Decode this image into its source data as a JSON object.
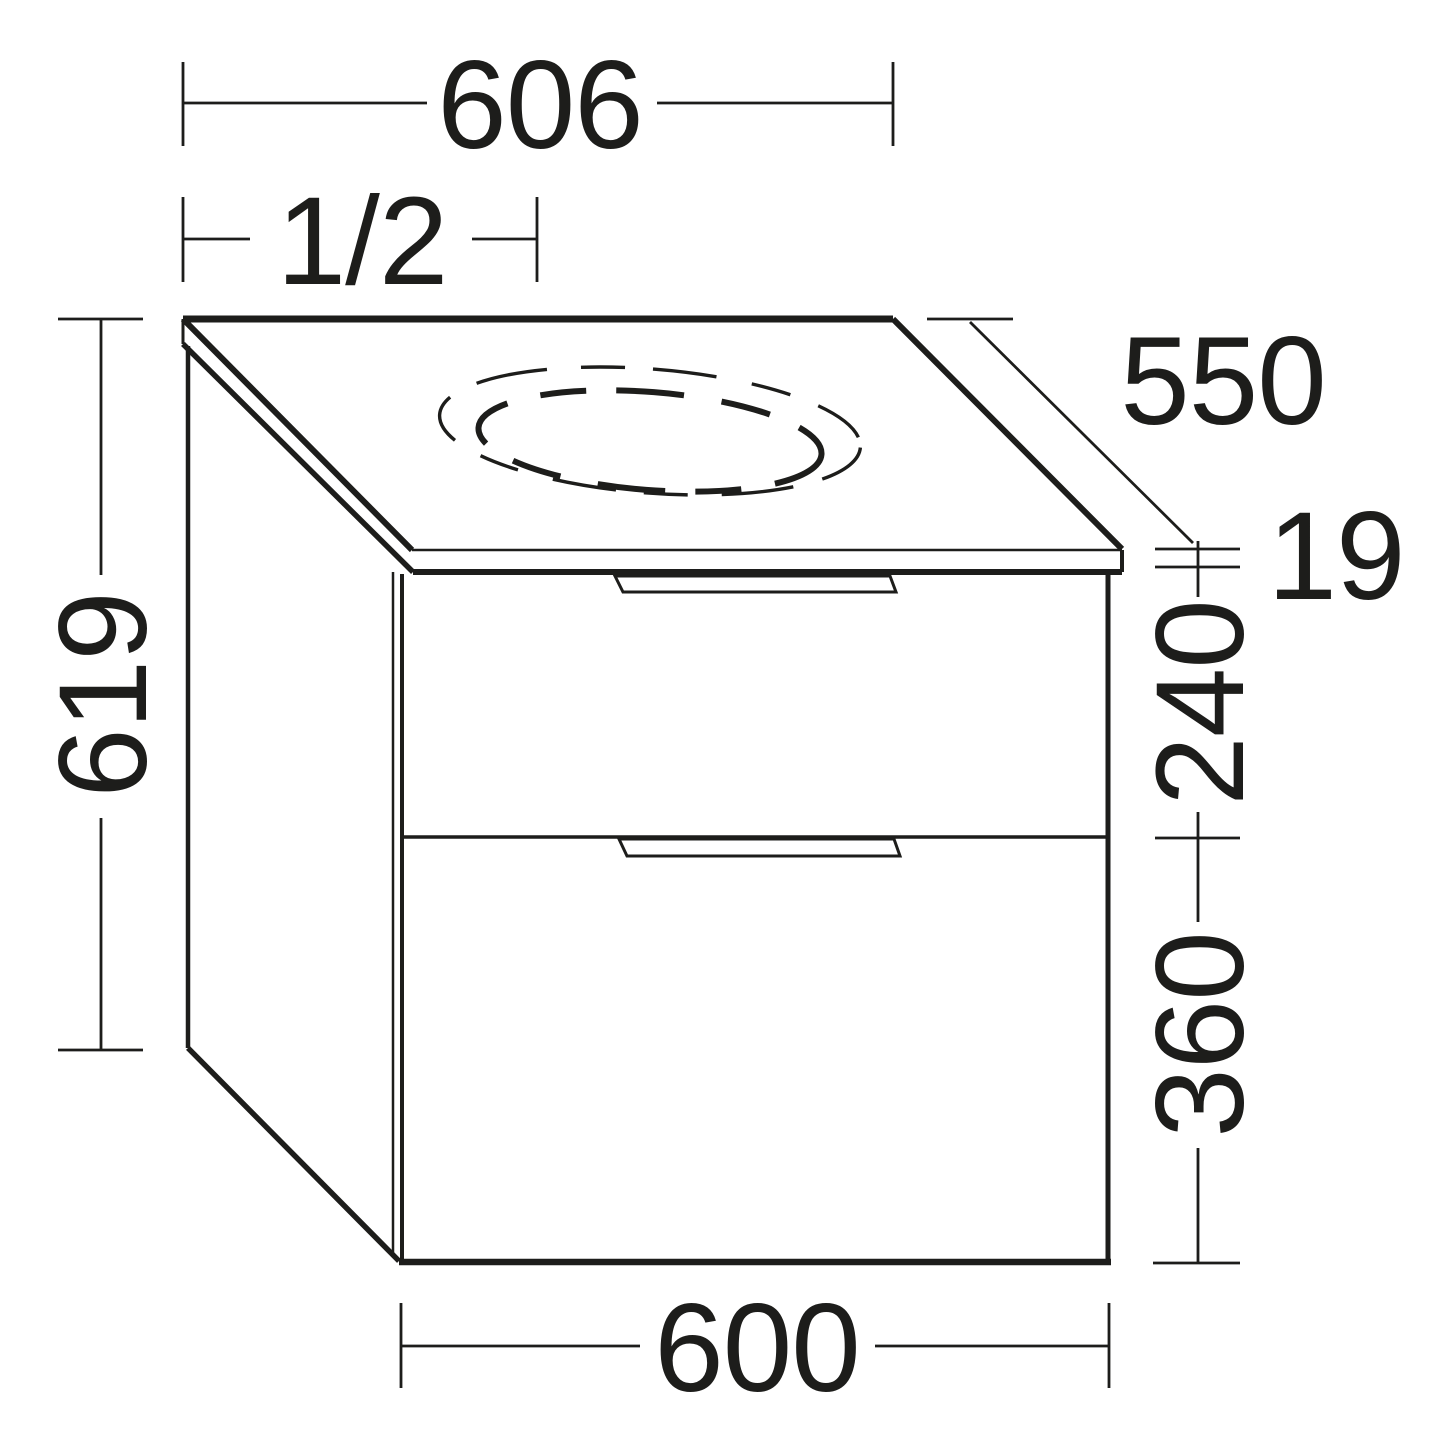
{
  "drawing": {
    "type": "furniture-dimension-drawing",
    "subject": "vanity-cabinet-with-countertop-two-drawers-and-basin-cutout"
  },
  "colors": {
    "ink": "#1d1d1b",
    "background": "#ffffff"
  },
  "dimensions": {
    "countertop_width": "606",
    "cutout_position": "1/2",
    "countertop_depth": "550",
    "countertop_thickness": "19",
    "upper_drawer_height": "240",
    "lower_drawer_height": "360",
    "total_height": "619",
    "body_width": "600"
  }
}
